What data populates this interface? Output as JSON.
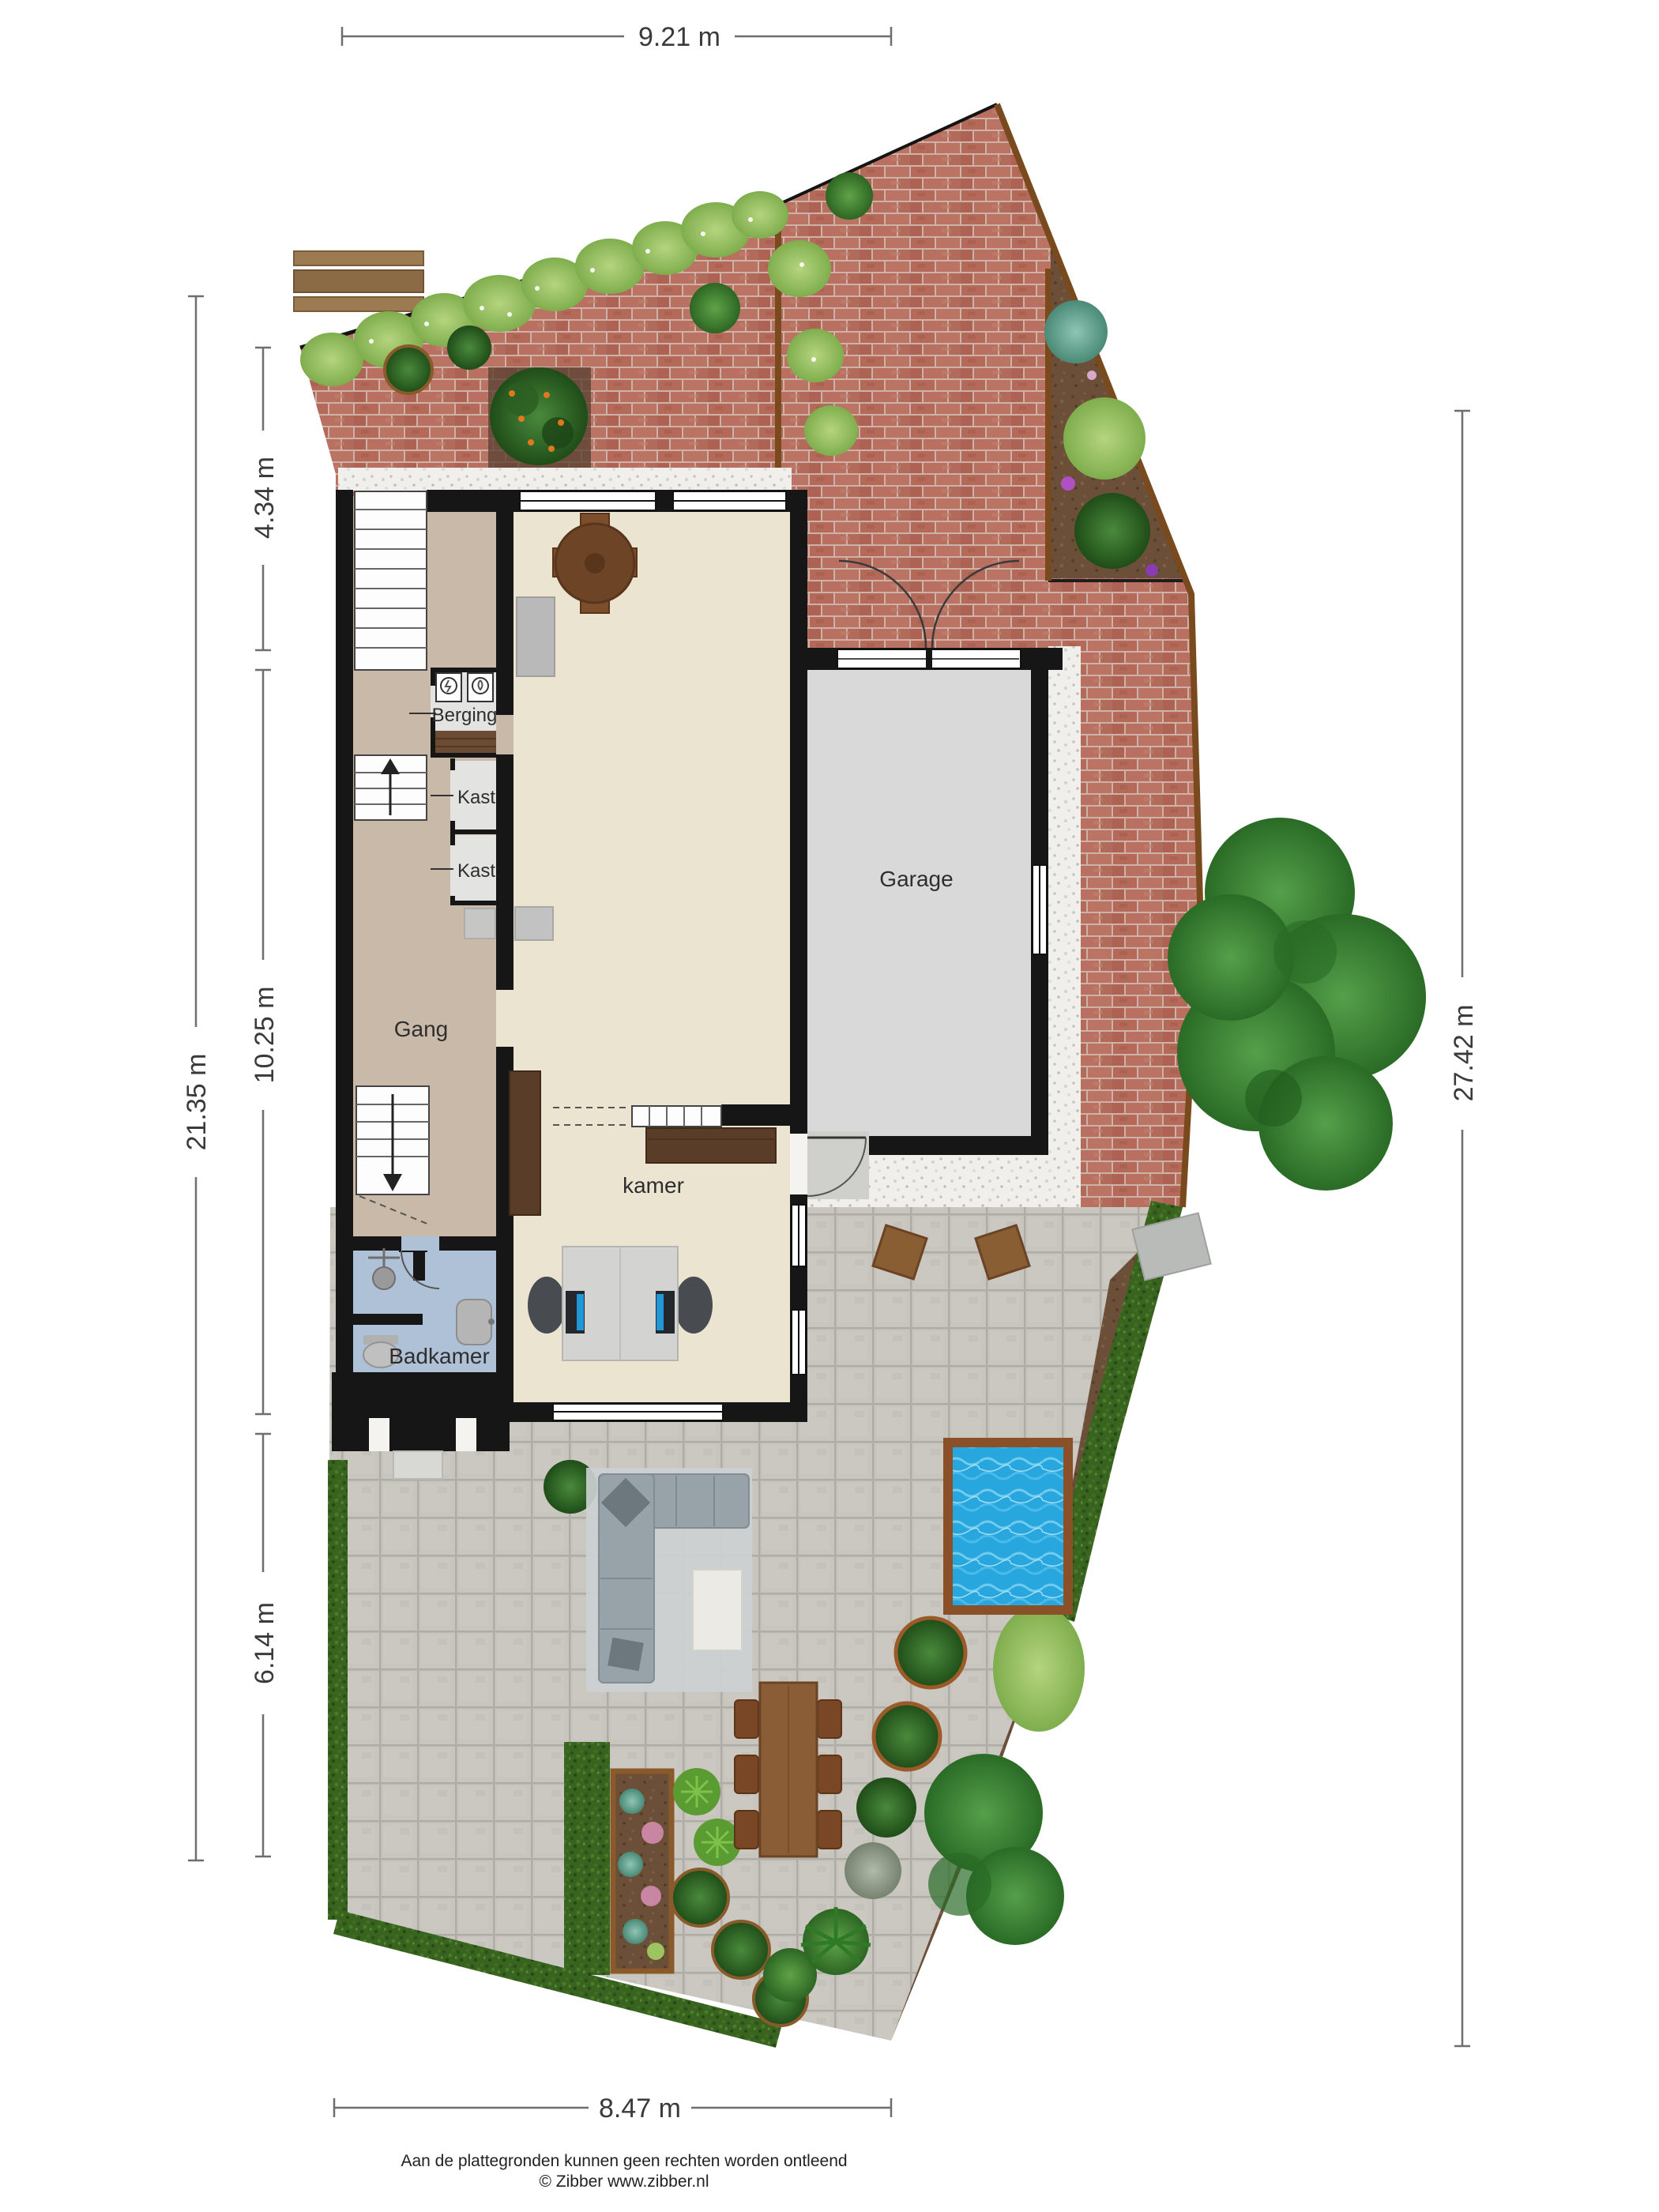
{
  "dimensions": {
    "top": "9.21 m",
    "left_outer": "21.35 m",
    "left_segment_top": "4.34 m",
    "left_segment_middle": "10.25 m",
    "left_segment_bottom": "6.14 m",
    "right": "27.42 m",
    "bottom": "8.47 m"
  },
  "rooms": {
    "berging": "Berging",
    "kast_upper": "Kast",
    "kast_lower": "Kast",
    "gang": "Gang",
    "garage": "Garage",
    "kamer": "kamer",
    "badkamer": "Badkamer"
  },
  "footer": {
    "disclaimer": "Aan de plattegronden kunnen geen rechten worden ontleend",
    "copyright": "© Zibber www.zibber.nl"
  },
  "colors": {
    "wall": "#161616",
    "brick_paving": "#b56a59",
    "paver_terrace": "#c7c5be",
    "hedge": "#39641f",
    "pool_water": "#27a7de",
    "pool_border": "#8a5128",
    "floor_hall": "#c8b9a8",
    "floor_room": "#eae4d0",
    "floor_garage": "#d9d9d9",
    "floor_bath": "#aec1d6",
    "floor_closet": "#e3e3e1",
    "wood_furniture": "#7a4f2e",
    "gravel": "#f0efeb"
  }
}
